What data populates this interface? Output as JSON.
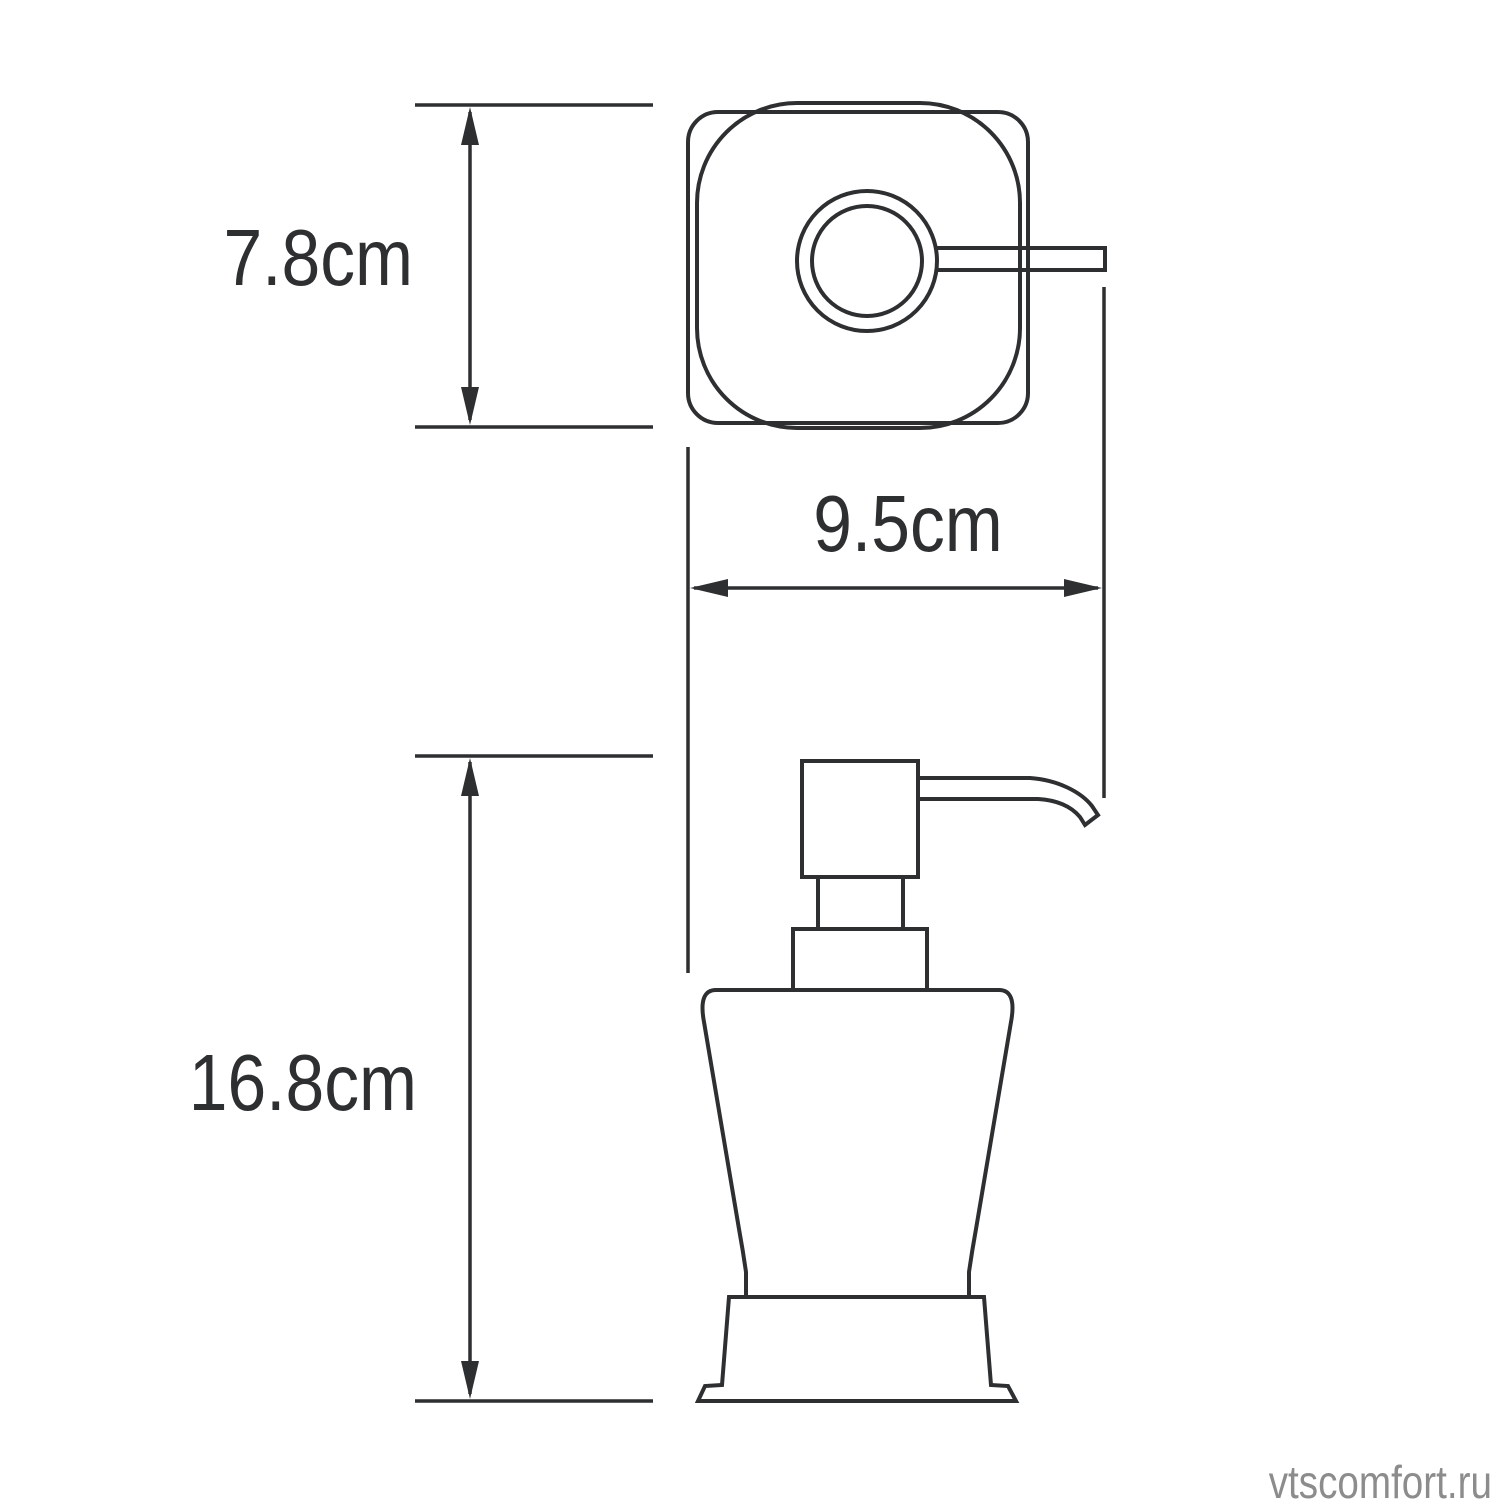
{
  "diagram": {
    "kind": "technical dimension drawing",
    "subject": "soap dispenser with pump",
    "views": {
      "top_view": "plan view of pump head with spout",
      "side_view": "elevation of dispenser body with pump and spout"
    }
  },
  "dimension_labels": {
    "depth": "7.8cm",
    "width": "9.5cm",
    "height": "16.8cm"
  },
  "watermark": "vtscomfort.ru",
  "colors": {
    "line": "#2d2f31",
    "label_text": "#2d2f31",
    "watermark_text": "#8c8c8c",
    "background": "#ffffff"
  }
}
